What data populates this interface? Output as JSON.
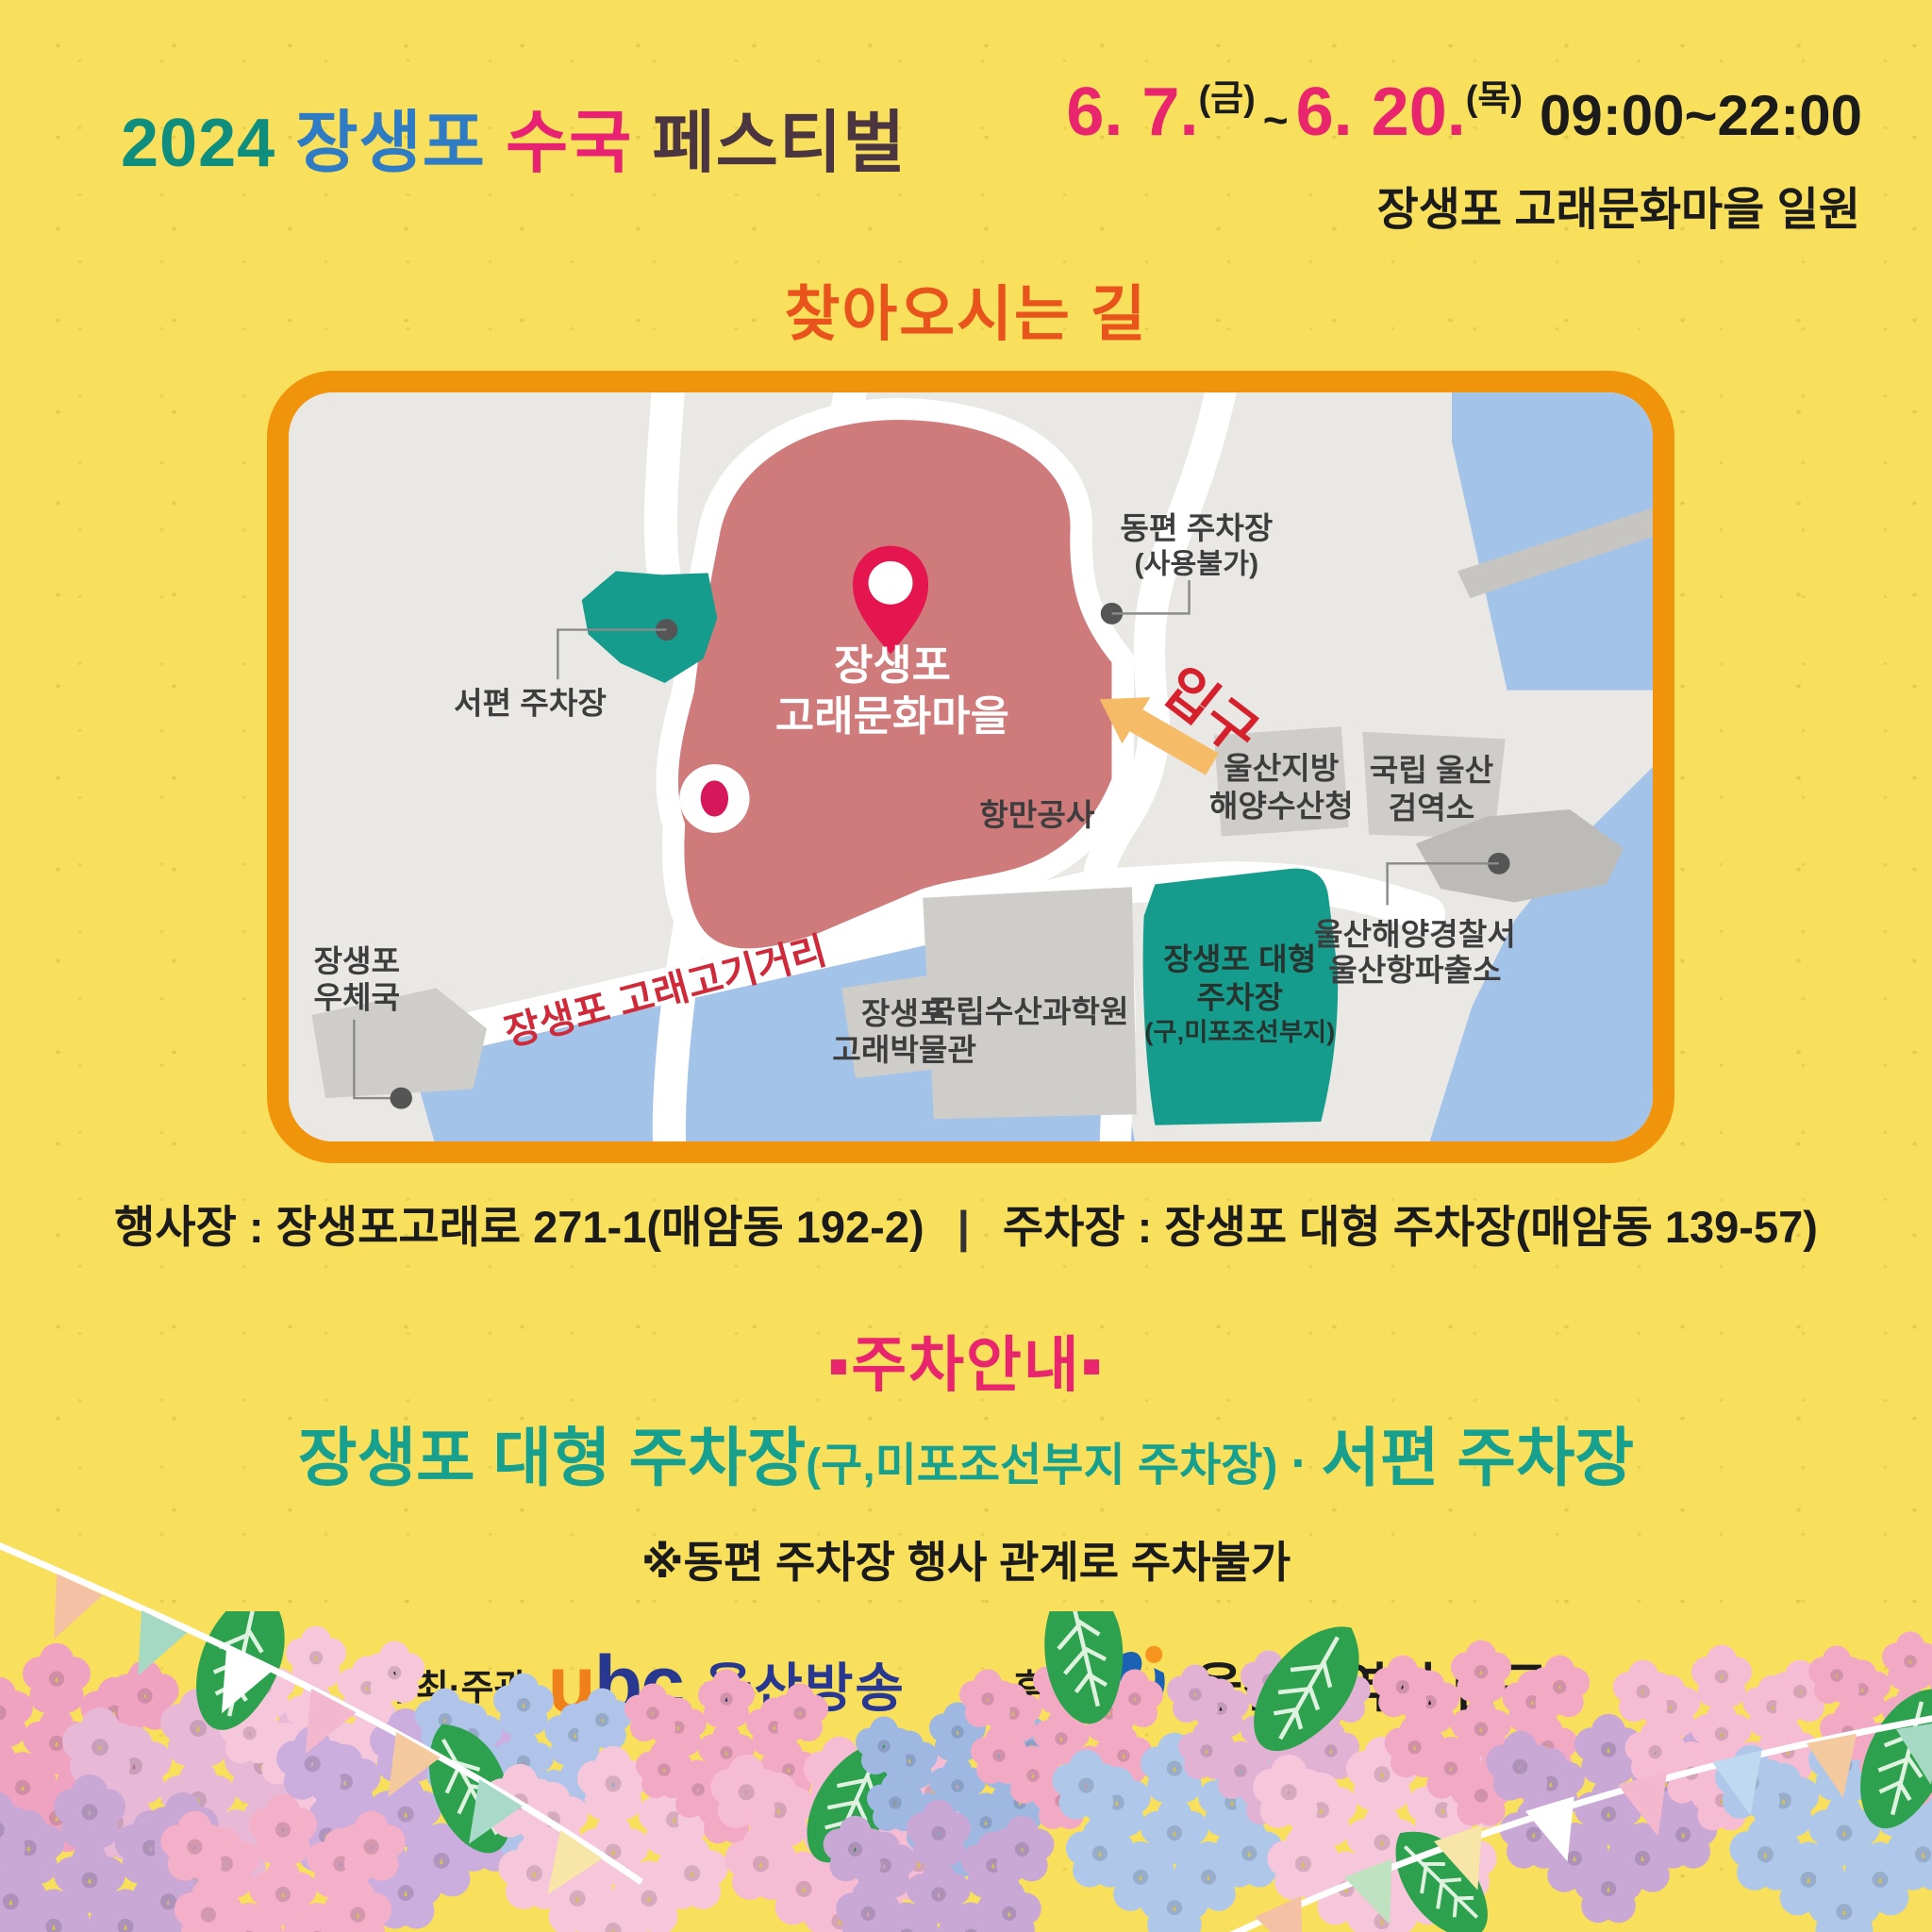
{
  "header": {
    "title": {
      "year": "2024",
      "place": "장생포",
      "flower": "수국",
      "festival": "페스티벌"
    },
    "schedule": {
      "start_date": "6. 7.",
      "start_day": "(금)",
      "tilde": "~",
      "end_date": "6. 20.",
      "end_day": "(목)",
      "hours": "09:00~22:00"
    },
    "venue": "장생포 고래문화마을 일원"
  },
  "directions": {
    "title": "찾아오시는 길"
  },
  "map": {
    "east_parking_1": "동편 주차장",
    "east_parking_2": "(사용불가)",
    "west_parking": "서편 주차장",
    "village_1": "장생포",
    "village_2": "고래문화마을",
    "entrance": "입구",
    "port_authority": "항만공사",
    "fisheries_1": "울산지방",
    "fisheries_2": "해양수산청",
    "quarantine_1": "국립 울산",
    "quarantine_2": "검역소",
    "police_1": "울산해양경찰서",
    "police_2": "울산항파출소",
    "whale_street": "장생포 고래고기거리",
    "post_office_1": "장생포",
    "post_office_2": "우체국",
    "museum_1": "장생포",
    "museum_2": "고래박물관",
    "science_institute": "국립수산과학원",
    "large_parking_1": "장생포 대형",
    "large_parking_2": "주차장",
    "large_parking_3": "(구,미포조선부지)"
  },
  "address": {
    "event_label": "행사장 :",
    "event_value": "장생포고래로 271-1(매암동 192-2)",
    "divider": "|",
    "parking_label": "주차장 :",
    "parking_value": "장생포 대형 주차장(매암동 139-57)"
  },
  "parking": {
    "title": "▪주차안내▪",
    "main_lot": "장생포 대형 주차장",
    "main_note": "(구,미포조선부지 주차장)",
    "dot": "·",
    "west_lot": "서편 주차장",
    "warning": "※동편 주차장 행사 관계로 주차불가"
  },
  "footer": {
    "organizer_label": "주최·주관",
    "ubc_u": "u",
    "ubc_bc": "bc",
    "ubc_name": "울산방송",
    "sponsor_label": "후원",
    "sponsor_name": "울산광역시 남구"
  },
  "colors": {
    "background": "#F9E05C",
    "map_border": "#F0940B",
    "teal_parking": "#169C8C",
    "village_rose": "#CF7B7B",
    "water_blue": "#A3C3E8",
    "accent_pink": "#E8256D",
    "accent_orange": "#E8541C",
    "title_teal": "#0F8E7E",
    "title_blue": "#2F7CC4",
    "title_dark": "#4A3540",
    "street_red": "#CE2A3A",
    "entrance_red": "#D6202C",
    "arrow_orange": "#F6BB66",
    "ubc_orange": "#F08019",
    "ubc_blue": "#283891"
  }
}
